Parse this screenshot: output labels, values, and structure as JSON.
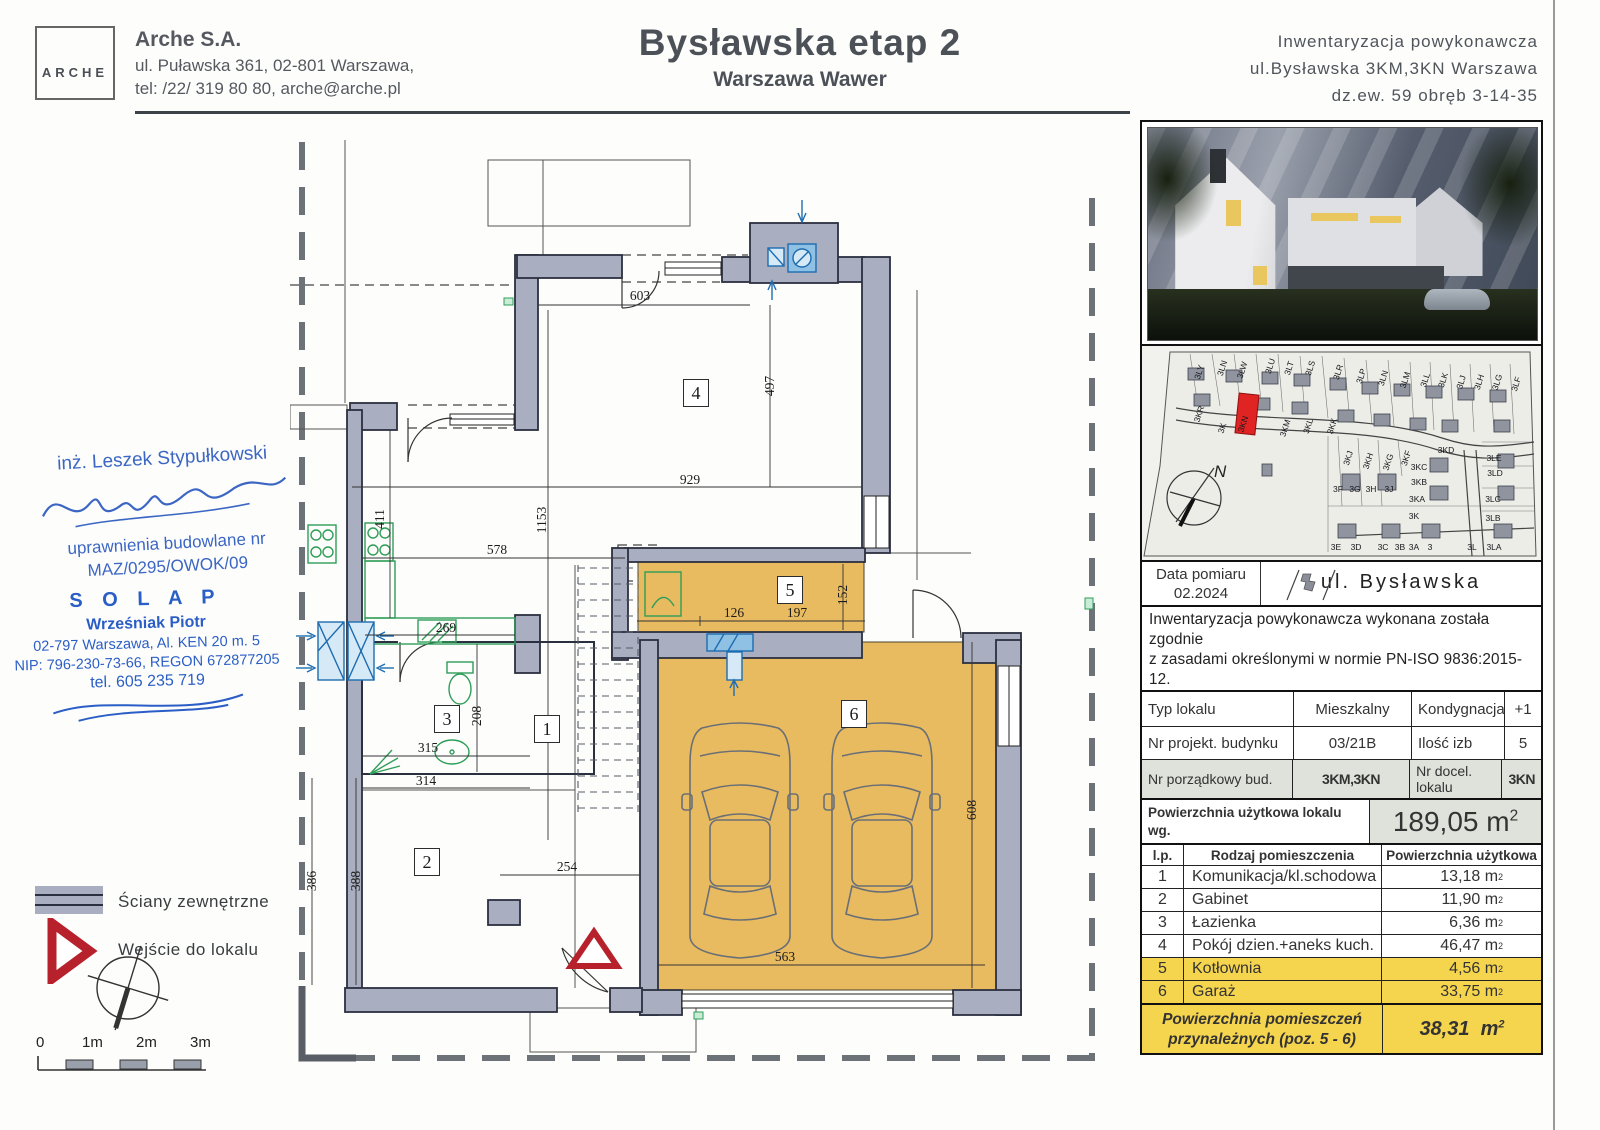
{
  "header": {
    "logo": "ARCHE",
    "company": "Arche S.A.",
    "address": "ul. Puławska 361, 02-801 Warszawa,",
    "contact": "tel: /22/ 319 80 80, arche@arche.pl",
    "title": "Bysławska etap 2",
    "subtitle": "Warszawa Wawer",
    "right_lines": [
      "Inwentaryzacja powykonawcza",
      "ul.Bysławska 3KM,3KN Warszawa",
      "dz.ew. 59 obręb 3-14-35"
    ]
  },
  "signature": {
    "name": "inż. Leszek Stypułkowski",
    "cred1": "uprawnienia budowlane nr",
    "cred2": "MAZ/0295/OWOK/09"
  },
  "stamp": {
    "l1": "S O L A P",
    "l2": "Wrześniak Piotr",
    "l3": "02-797 Warszawa, Al. KEN 20 m. 5",
    "l4": "NIP: 796-230-73-66, REGON 672877205",
    "l5": "tel. 605 235 719"
  },
  "legend": {
    "walls": "Ściany zewnętrzne",
    "entrance": "Wejście do lokalu",
    "scale_ticks": [
      "0",
      "1m",
      "2m",
      "3m"
    ]
  },
  "plan": {
    "rooms": [
      {
        "n": "4",
        "x": 406,
        "y": 253
      },
      {
        "n": "1",
        "x": 257,
        "y": 589
      },
      {
        "n": "3",
        "x": 157,
        "y": 579
      },
      {
        "n": "2",
        "x": 137,
        "y": 722
      },
      {
        "n": "5",
        "x": 500,
        "y": 450
      },
      {
        "n": "6",
        "x": 564,
        "y": 574
      }
    ],
    "dimensions": [
      {
        "t": "603",
        "x": 350,
        "y": 157
      },
      {
        "t": "497",
        "x": 480,
        "y": 246,
        "v": 1
      },
      {
        "t": "929",
        "x": 400,
        "y": 341
      },
      {
        "t": "1153",
        "x": 252,
        "y": 380,
        "v": 1
      },
      {
        "t": "578",
        "x": 207,
        "y": 411
      },
      {
        "t": "411",
        "x": 90,
        "y": 379,
        "v": 1
      },
      {
        "t": "269",
        "x": 156,
        "y": 489
      },
      {
        "t": "208",
        "x": 187,
        "y": 576,
        "v": 1
      },
      {
        "t": "315",
        "x": 138,
        "y": 609
      },
      {
        "t": "314",
        "x": 136,
        "y": 642
      },
      {
        "t": "254",
        "x": 277,
        "y": 728
      },
      {
        "t": "386",
        "x": 22,
        "y": 741,
        "v": 1
      },
      {
        "t": "388",
        "x": 66,
        "y": 741,
        "v": 1
      },
      {
        "t": "126",
        "x": 444,
        "y": 474
      },
      {
        "t": "197",
        "x": 507,
        "y": 474
      },
      {
        "t": "152",
        "x": 553,
        "y": 455,
        "v": 1
      },
      {
        "t": "563",
        "x": 495,
        "y": 818
      },
      {
        "t": "608",
        "x": 682,
        "y": 670,
        "v": 1
      }
    ]
  },
  "sitemap": {
    "date_label": "Data pomiaru",
    "date_value": "02.2024",
    "street": "ul. Bysławska",
    "north": "N",
    "plots": [
      {
        "t": "3LY",
        "x": 57,
        "y": 26
      },
      {
        "t": "3LN",
        "x": 80,
        "y": 22
      },
      {
        "t": "3LW",
        "x": 100,
        "y": 24
      },
      {
        "t": "3LU",
        "x": 128,
        "y": 20
      },
      {
        "t": "3LT",
        "x": 147,
        "y": 22
      },
      {
        "t": "3LS",
        "x": 168,
        "y": 22
      },
      {
        "t": "3LR",
        "x": 196,
        "y": 26
      },
      {
        "t": "3LP",
        "x": 219,
        "y": 30
      },
      {
        "t": "3LN",
        "x": 241,
        "y": 32
      },
      {
        "t": "3LM",
        "x": 263,
        "y": 34
      },
      {
        "t": "3LL",
        "x": 283,
        "y": 34
      },
      {
        "t": "3LK",
        "x": 301,
        "y": 34
      },
      {
        "t": "3LJ",
        "x": 319,
        "y": 36
      },
      {
        "t": "3LH",
        "x": 337,
        "y": 36
      },
      {
        "t": "3LG",
        "x": 355,
        "y": 36
      },
      {
        "t": "3LF",
        "x": 374,
        "y": 38
      },
      {
        "t": "3KR",
        "x": 57,
        "y": 68
      },
      {
        "t": "3K",
        "x": 80,
        "y": 82
      },
      {
        "t": "3KN",
        "x": 101,
        "y": 78
      },
      {
        "t": "3KM",
        "x": 143,
        "y": 82
      },
      {
        "t": "3KL",
        "x": 166,
        "y": 80
      },
      {
        "t": "3KK",
        "x": 190,
        "y": 80
      },
      {
        "t": "3KJ",
        "x": 206,
        "y": 112
      },
      {
        "t": "3KH",
        "x": 226,
        "y": 115
      },
      {
        "t": "3KG",
        "x": 246,
        "y": 116
      },
      {
        "t": "3KF",
        "x": 264,
        "y": 112
      },
      {
        "t": "3KD",
        "x": 304,
        "y": 104,
        "h": 1
      },
      {
        "t": "3KC",
        "x": 277,
        "y": 121,
        "h": 1
      },
      {
        "t": "3KB",
        "x": 277,
        "y": 136,
        "h": 1
      },
      {
        "t": "3KA",
        "x": 275,
        "y": 153,
        "h": 1
      },
      {
        "t": "3K",
        "x": 272,
        "y": 170,
        "h": 1
      },
      {
        "t": "3F",
        "x": 196,
        "y": 143,
        "h": 1
      },
      {
        "t": "3G",
        "x": 213,
        "y": 143,
        "h": 1
      },
      {
        "t": "3H",
        "x": 229,
        "y": 143,
        "h": 1
      },
      {
        "t": "3J",
        "x": 247,
        "y": 143,
        "h": 1
      },
      {
        "t": "3LE",
        "x": 352,
        "y": 112,
        "h": 1
      },
      {
        "t": "3LD",
        "x": 353,
        "y": 127,
        "h": 1
      },
      {
        "t": "3LC",
        "x": 351,
        "y": 153,
        "h": 1
      },
      {
        "t": "3LB",
        "x": 351,
        "y": 172,
        "h": 1
      },
      {
        "t": "3E",
        "x": 194,
        "y": 201,
        "h": 1
      },
      {
        "t": "3D",
        "x": 214,
        "y": 201,
        "h": 1
      },
      {
        "t": "3C",
        "x": 241,
        "y": 201,
        "h": 1
      },
      {
        "t": "3B",
        "x": 258,
        "y": 201,
        "h": 1
      },
      {
        "t": "3A",
        "x": 272,
        "y": 201,
        "h": 1
      },
      {
        "t": "3",
        "x": 288,
        "y": 201,
        "h": 1
      },
      {
        "t": "3L",
        "x": 330,
        "y": 201,
        "h": 1
      },
      {
        "t": "3LA",
        "x": 352,
        "y": 201,
        "h": 1
      }
    ]
  },
  "panel": {
    "note_lines": [
      "Inwentaryzacja powykonawcza wykonana została zgodnie",
      "z zasadami określonymi w normie PN-ISO 9836:2015-12.",
      "Pomiary wykonano z dokładnością ± 5 mm w świetle",
      "tynku,wymiary zaokrąglone zostały do 1cm."
    ],
    "info_rows": [
      [
        "Typ lokalu",
        "Mieszkalny",
        "Kondygnacja",
        "+1"
      ],
      [
        "Nr projekt. budynku",
        "03/21B",
        "Ilość izb",
        "5"
      ],
      [
        "Nr porządkowy bud.",
        "3KM,3KN",
        "Nr docel. lokalu",
        "3KN"
      ]
    ],
    "area_label1": "Powierzchnia użytkowa lokalu wg.",
    "area_label2": "PN-ISO 9836:2015-12 (kond. +1 i +2)",
    "area_value": "189,05",
    "unit_base": "m",
    "unit_sup": "2",
    "list_header": [
      "l.p.",
      "Rodzaj pomieszczenia",
      "Powierzchnia użytkowa"
    ],
    "room_rows": [
      {
        "lp": "1",
        "name": "Komunikacja/kl.schodowa",
        "area": "13,18",
        "hl": false
      },
      {
        "lp": "2",
        "name": "Gabinet",
        "area": "11,90",
        "hl": false
      },
      {
        "lp": "3",
        "name": "Łazienka",
        "area": "6,36",
        "hl": false
      },
      {
        "lp": "4",
        "name": "Pokój dzien.+aneks kuch.",
        "area": "46,47",
        "hl": false
      },
      {
        "lp": "5",
        "name": "Kotłownia",
        "area": "4,56",
        "hl": true
      },
      {
        "lp": "6",
        "name": "Garaż",
        "area": "33,75",
        "hl": true
      }
    ],
    "summary_label1": "Powierzchnia pomieszczeń",
    "summary_label2": "przynależnych (poz. 5 - 6)",
    "summary_value": "38,31"
  }
}
